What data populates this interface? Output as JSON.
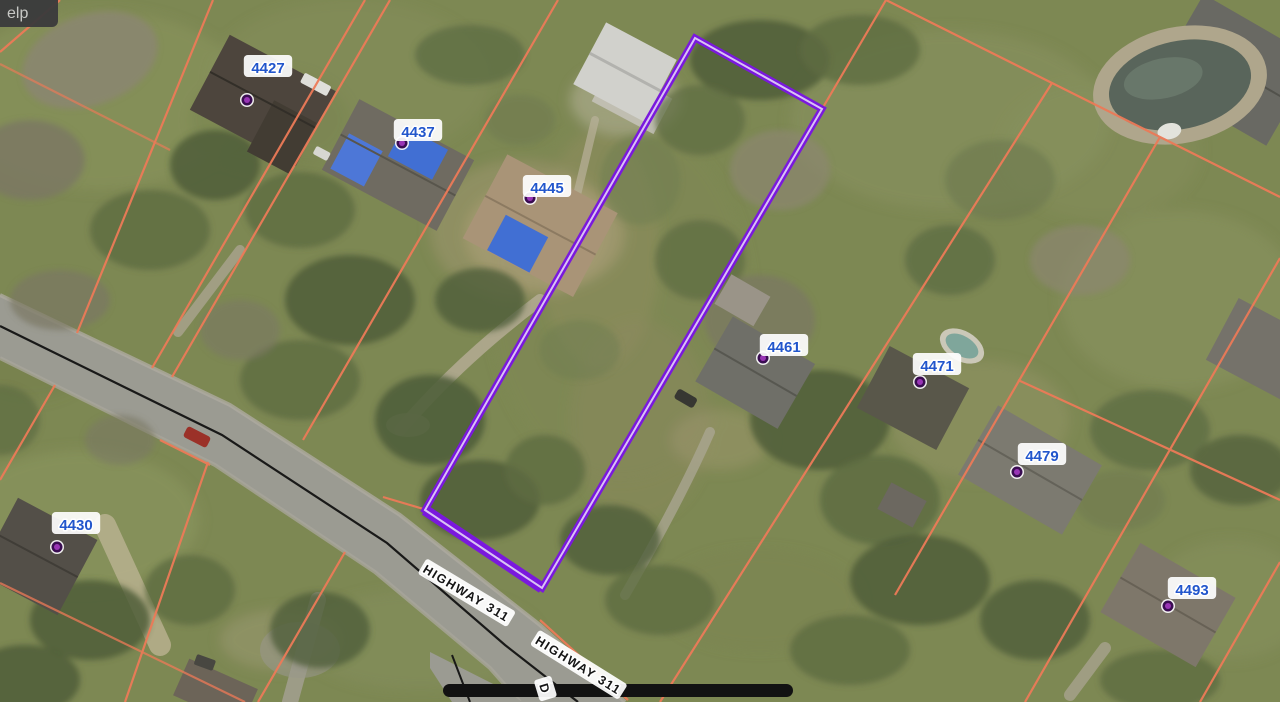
{
  "ui": {
    "menu_fragment_text": "elp"
  },
  "map": {
    "type": "aerial-parcel-map",
    "colors": {
      "parcel_line": "#ec7a58",
      "selected_parcel_outline": "#7a18dd",
      "selected_parcel_inner": "#d9c2f5",
      "address_text": "#2256cc",
      "road_label_text": "#161616",
      "marker_dot": "#9935b5",
      "marker_dot_ring": "#3a0d52"
    },
    "address_markers": [
      {
        "text": "4427",
        "x": 268,
        "y": 68,
        "dot_x": 247,
        "dot_y": 100
      },
      {
        "text": "4437",
        "x": 418,
        "y": 132,
        "dot_x": 402,
        "dot_y": 143
      },
      {
        "text": "4445",
        "x": 547,
        "y": 188,
        "dot_x": 530,
        "dot_y": 198
      },
      {
        "text": "4461",
        "x": 784,
        "y": 347,
        "dot_x": 763,
        "dot_y": 358
      },
      {
        "text": "4471",
        "x": 937,
        "y": 366,
        "dot_x": 920,
        "dot_y": 382
      },
      {
        "text": "4479",
        "x": 1042,
        "y": 456,
        "dot_x": 1017,
        "dot_y": 472
      },
      {
        "text": "4430",
        "x": 76,
        "y": 525,
        "dot_x": 57,
        "dot_y": 547
      },
      {
        "text": "4493",
        "x": 1192,
        "y": 590,
        "dot_x": 1168,
        "dot_y": 606
      }
    ],
    "road_labels": [
      {
        "text": "HIGHWAY 311",
        "x": 466,
        "y": 594,
        "rot": 31
      },
      {
        "text": "HIGHWAY 311",
        "x": 578,
        "y": 666,
        "rot": 32
      },
      {
        "text": "D",
        "x": 544,
        "y": 689,
        "rot": 73
      }
    ]
  }
}
